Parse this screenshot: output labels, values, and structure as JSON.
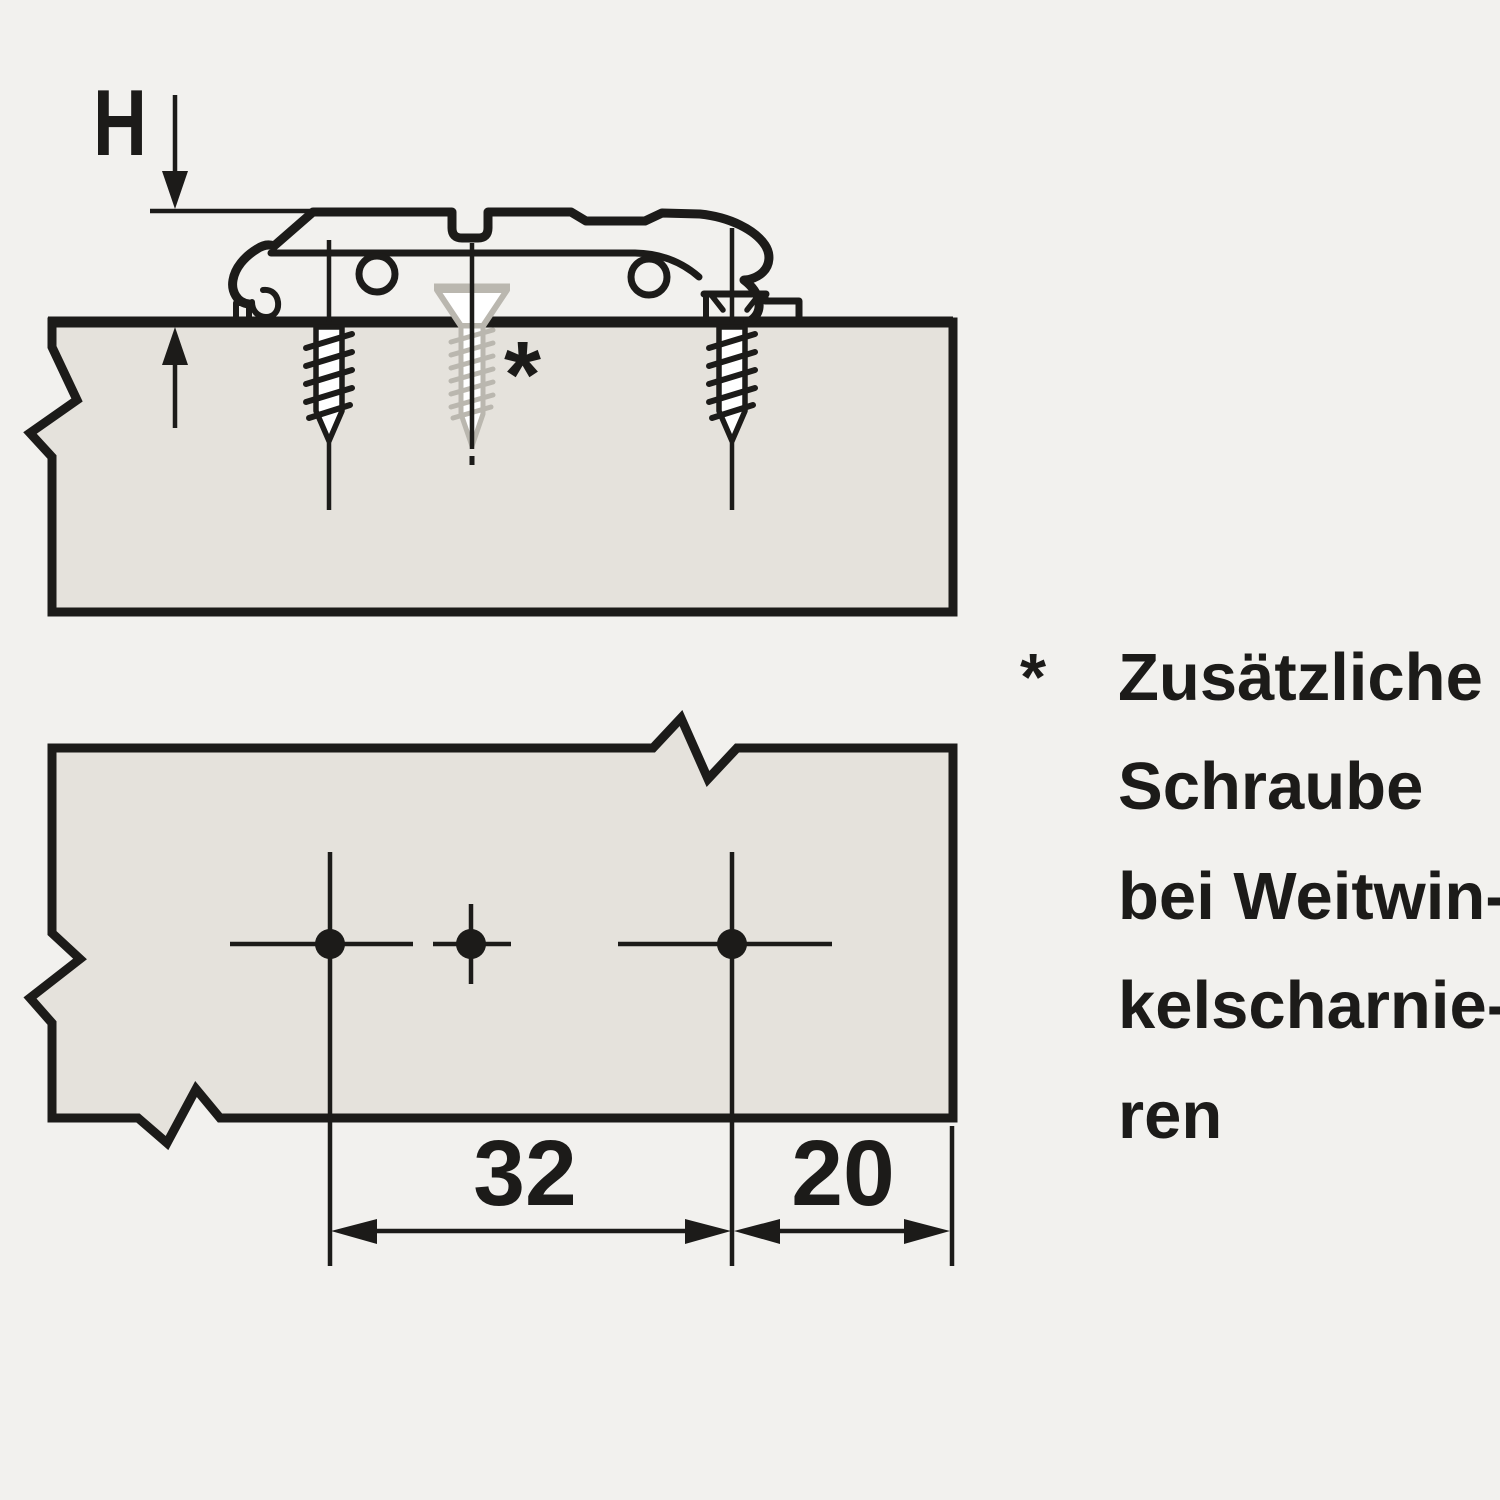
{
  "drawing": {
    "side_view": {
      "height_label": "H",
      "asterisk_marker": "*"
    },
    "top_view": {
      "hole_spacing_label": "32",
      "edge_distance_label": "20"
    },
    "legend": {
      "marker": "*",
      "lines": [
        "Zusätzliche",
        "Schraube",
        "bei Weitwin-",
        "kelscharnie-",
        "ren"
      ]
    }
  },
  "colors": {
    "background": "#f2f1ee",
    "panel_fill": "#e5e2dc",
    "line_ink": "#1c1b19",
    "muted_screw_gray": "#bab7af"
  }
}
